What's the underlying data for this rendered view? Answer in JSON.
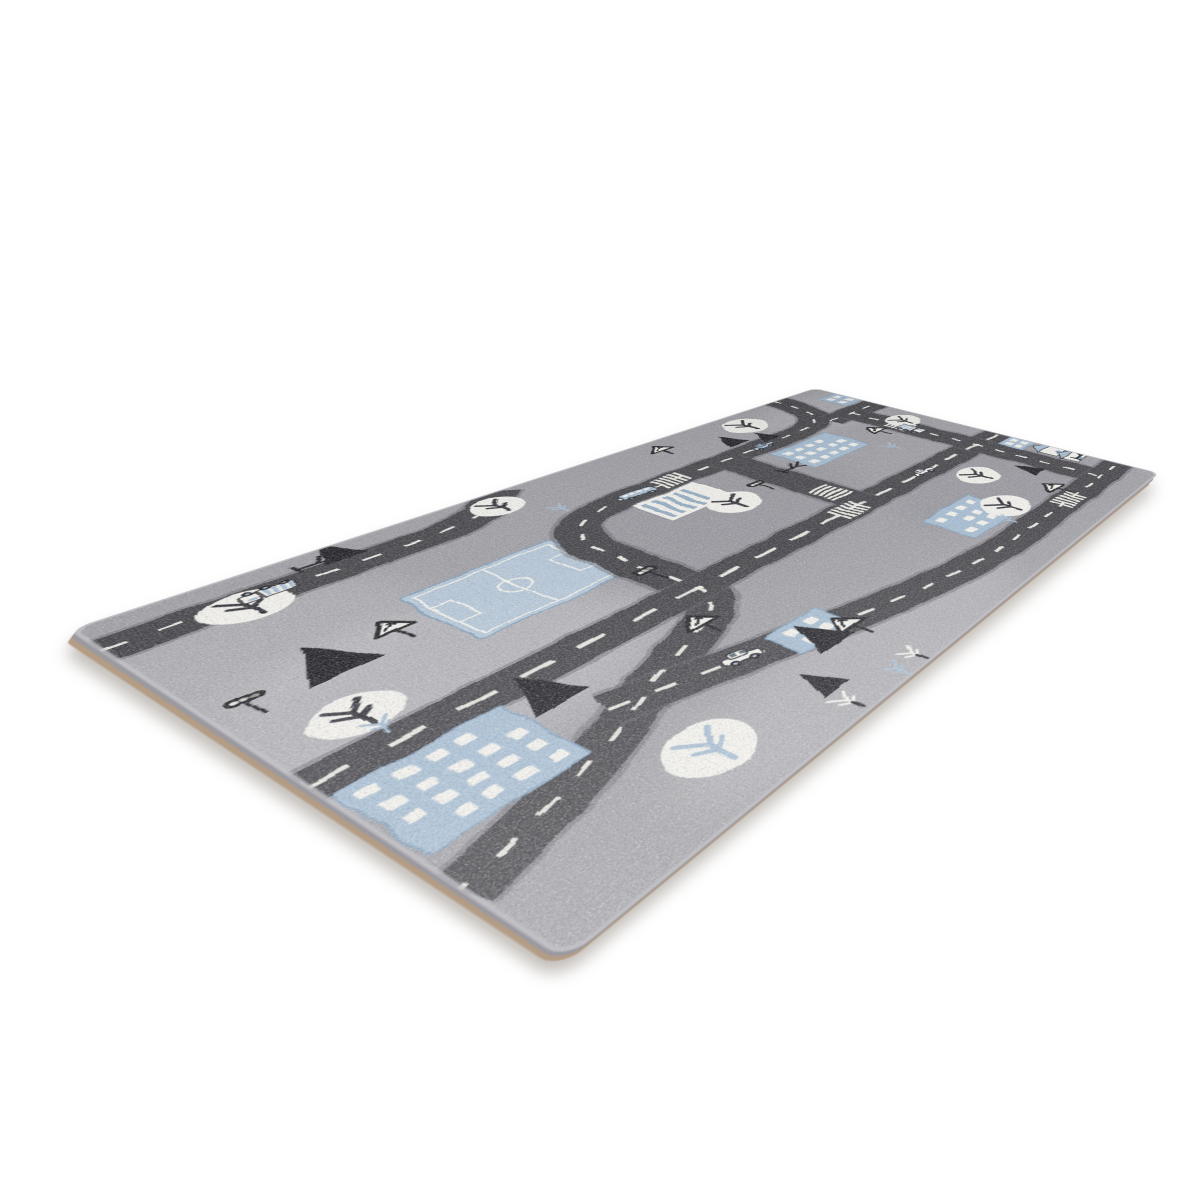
{
  "scene": {
    "type": "product-photo",
    "background_color": "#ffffff",
    "subject": "grey children's play rug with a city street map design, photographed at an angle on a white background"
  },
  "rug": {
    "colors": {
      "rug_base": "#9b9ba1",
      "base_light": "#c2c2c7",
      "base_dark": "#81818a",
      "road": "#3d3d43",
      "road_edge": "#5a5a61",
      "marking": "#efeee7",
      "blue": "#a2bad0",
      "blue_deep": "#7e9cb9",
      "field": "#b4c7d9",
      "white": "#f2f1ec",
      "black": "#17171a",
      "wheel_hub": "#9db4c8",
      "window_glass": "#53616e",
      "backing": "#b29b85",
      "pile": "#9a9aa0"
    },
    "design": {
      "width": 850,
      "height": 600,
      "corner_radius": 14,
      "roads": [
        {
          "name": "country-lane",
          "d": "M 0 56 H 232 C 285 56 305 42 330 12 L 342 0",
          "dash": "16 20"
        },
        {
          "name": "main-s-road",
          "d": "M 762 0 C 762 80 750 122 664 124 L 430 124 C 330 126 312 150 311 240 L 311 346 C 311 400 240 408 172 444 C 112 476 58 496 0 508",
          "dash": "16 20"
        },
        {
          "name": "top-right-avenue",
          "d": "M 745 124 H 850",
          "dash": "16 20"
        },
        {
          "name": "main-avenue",
          "d": "M 0 346 H 850",
          "dash": "26 22",
          "dw": 5
        },
        {
          "name": "cross-street",
          "d": "M 551 124 V 346"
        },
        {
          "name": "right-street",
          "d": "M 790 124 V 540",
          "dash": "16 20"
        },
        {
          "name": "lower-road",
          "d": "M 150 434 C 270 470 420 536 565 540 L 850 540",
          "dash": "16 20"
        }
      ],
      "crosswalks": [
        {
          "x": 470,
          "y": 124,
          "a": 0
        },
        {
          "x": 525,
          "y": 346,
          "a": 0
        },
        {
          "x": 790,
          "y": 215,
          "a": 90
        },
        {
          "x": 551,
          "y": 295,
          "a": 90
        },
        {
          "x": 700,
          "y": 540,
          "a": 0
        }
      ],
      "soccer_field": {
        "x": 158,
        "y": 152,
        "w": 140,
        "h": 118
      },
      "tree_circles": [
        {
          "x": 88,
          "y": 66,
          "r": 30,
          "c": "dark"
        },
        {
          "x": 318,
          "y": 38,
          "r": 26,
          "c": "dark"
        },
        {
          "x": 658,
          "y": 48,
          "r": 30,
          "c": "dark"
        },
        {
          "x": 56,
          "y": 292,
          "r": 28,
          "c": "dark"
        },
        {
          "x": 468,
          "y": 228,
          "r": 30,
          "c": "dark"
        },
        {
          "x": 810,
          "y": 205,
          "r": 26,
          "c": "dark"
        },
        {
          "x": 160,
          "y": 530,
          "r": 32,
          "c": "blue"
        },
        {
          "x": 640,
          "y": 486,
          "r": 30,
          "c": "dark"
        },
        {
          "x": 700,
          "y": 408,
          "r": 28,
          "c": "dark"
        }
      ],
      "fir_trees": [
        {
          "x": 175,
          "y": 40,
          "w": 36,
          "h": 46
        },
        {
          "x": 604,
          "y": 96,
          "w": 34,
          "h": 44
        },
        {
          "x": 643,
          "y": 116,
          "w": 30,
          "h": 38
        },
        {
          "x": 80,
          "y": 232,
          "w": 54,
          "h": 62
        },
        {
          "x": 140,
          "y": 400,
          "w": 46,
          "h": 58
        },
        {
          "x": 310,
          "y": 516,
          "w": 40,
          "h": 50
        },
        {
          "x": 756,
          "y": 468,
          "w": 30,
          "h": 40
        },
        {
          "x": 260,
          "y": 560,
          "w": 30,
          "h": 38
        }
      ],
      "bare_trees": [
        {
          "x": 140,
          "y": 30
        },
        {
          "x": 566,
          "y": 208
        },
        {
          "x": 828,
          "y": 484
        }
      ],
      "small_trees": [
        {
          "x": 352,
          "y": 92,
          "c": "blue"
        },
        {
          "x": 716,
          "y": 256,
          "c": "blue"
        },
        {
          "x": 608,
          "y": 506,
          "c": "blue"
        },
        {
          "x": 58,
          "y": 318,
          "c": "blue"
        },
        {
          "x": 252,
          "y": 576,
          "c": "white"
        },
        {
          "x": 332,
          "y": 580,
          "c": "white"
        },
        {
          "x": 308,
          "y": 584,
          "c": "blue"
        }
      ],
      "buildings": [
        {
          "x": 6,
          "y": 366,
          "w": 108,
          "h": 100,
          "type": "windows"
        },
        {
          "x": 600,
          "y": 152,
          "w": 104,
          "h": 78,
          "type": "windows"
        },
        {
          "x": 548,
          "y": 432,
          "w": 92,
          "h": 72,
          "type": "windows"
        },
        {
          "x": 282,
          "y": 460,
          "w": 62,
          "h": 44,
          "type": "windows"
        },
        {
          "x": 810,
          "y": 44,
          "w": 40,
          "h": 52,
          "type": "windows"
        },
        {
          "x": 812,
          "y": 368,
          "w": 38,
          "h": 40,
          "type": "windows"
        },
        {
          "x": 396,
          "y": 148,
          "w": 88,
          "h": 66,
          "type": "striped"
        }
      ],
      "houses": [
        {
          "x": 820,
          "y": 430,
          "w": 36,
          "h": 28
        },
        {
          "x": 818,
          "y": 468,
          "w": 32,
          "h": 24
        }
      ],
      "vehicles": [
        {
          "x": 108,
          "y": 54,
          "a": 180,
          "kind": "truck"
        },
        {
          "x": 424,
          "y": 124,
          "a": 0,
          "kind": "bus"
        },
        {
          "x": 614,
          "y": 124,
          "a": 0,
          "kind": "car",
          "c": "blue"
        },
        {
          "x": 790,
          "y": 236,
          "a": 90,
          "kind": "truck"
        },
        {
          "x": 252,
          "y": 464,
          "a": 18,
          "kind": "car",
          "c": "white"
        },
        {
          "x": 668,
          "y": 346,
          "a": 0,
          "kind": "car",
          "c": "white"
        }
      ],
      "traffic_lights": [
        {
          "x": 308,
          "y": 284
        },
        {
          "x": 520,
          "y": 212
        },
        {
          "x": 26,
          "y": 214
        }
      ],
      "signs": [
        {
          "x": 530,
          "y": 28
        },
        {
          "x": 132,
          "y": 192
        },
        {
          "x": 271,
          "y": 390
        },
        {
          "x": 338,
          "y": 498
        },
        {
          "x": 755,
          "y": 196
        },
        {
          "x": 722,
          "y": 500
        }
      ]
    }
  }
}
